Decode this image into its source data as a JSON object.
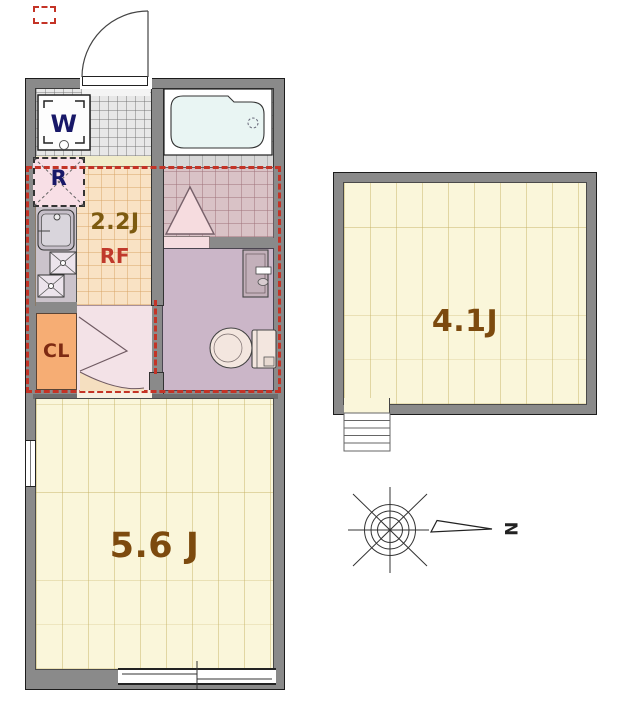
{
  "plan": {
    "type": "apartment-floor-plan",
    "rooms": {
      "kitchen": {
        "size_label": "2.2J",
        "loft_label": "RF"
      },
      "main_room": {
        "size_label": "5.6 J"
      },
      "loft_room": {
        "size_label": "4.1J"
      },
      "closet": {
        "label": "CL"
      },
      "refrigerator_space": {
        "label": "R"
      },
      "washing_machine": {
        "label": "W"
      }
    },
    "compass": {
      "north_label": "N"
    },
    "fixtures": [
      "bathtub",
      "toilet",
      "wash-basin",
      "kitchen-sink",
      "gas-burner",
      "washing-machine-pan",
      "loft-ladder",
      "loft-steps",
      "entrance-door",
      "hallway-door",
      "sliding-window"
    ],
    "colors": {
      "wall": "#8a8a8a",
      "wood_floor": "#faf6da",
      "kitchen_floor": "#f9e2c4",
      "shower_tile": "#d9c2c6",
      "toilet_room_floor": "#cbb6c8",
      "closet": "#f6ad74",
      "hallway": "#f3e2e7",
      "loft_boundary_red": "#c43326",
      "label_brown": "#7c4a0e",
      "label_navy": "#181868",
      "label_red": "#c0392b",
      "label_maroon": "#7e2a12"
    }
  }
}
